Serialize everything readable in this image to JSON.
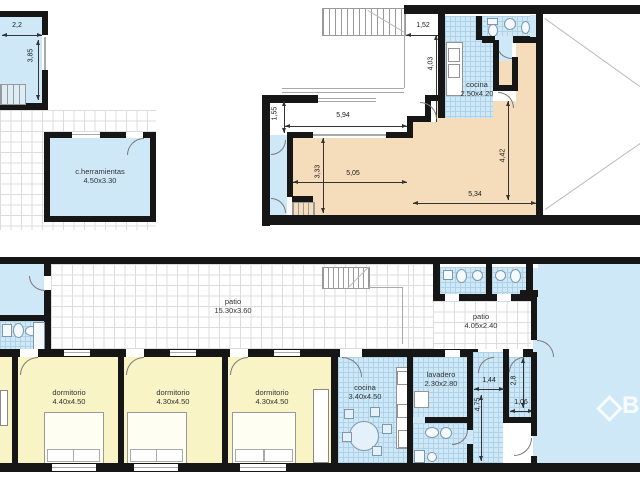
{
  "plan": {
    "upper": {
      "room_tl": {
        "width_dim": "2,2",
        "height_dim": "3,85"
      },
      "herramientas": {
        "name": "c.herramientas",
        "size": "4.50x3.30"
      },
      "cocina": {
        "name": "cocina",
        "size": "2.50x4.20"
      },
      "dims": {
        "stair_gap": "1,52",
        "void_height": "4,03",
        "void_width": "5,94",
        "entry_width": "1,55",
        "hall_height": "3,33",
        "hall_width": "5,05",
        "living_height": "4,42",
        "living_width": "5,34"
      }
    },
    "lower": {
      "patio_main": {
        "name": "patio",
        "size": "15.30x3.60"
      },
      "patio_small": {
        "name": "patio",
        "size": "4.05x2.40"
      },
      "dorm1": {
        "name": "dormitorio",
        "size": "4.40x4.50"
      },
      "dorm2": {
        "name": "dormitorio",
        "size": "4.30x4.50"
      },
      "dorm3": {
        "name": "dormitorio",
        "size": "4.30x4.50"
      },
      "cocina": {
        "name": "cocina",
        "size": "3.40x4.50"
      },
      "lavadero": {
        "name": "lavadero",
        "size": "2.30x2.80"
      },
      "dims": {
        "corridor_width": "1,44",
        "corridor_length": "4,75",
        "small_room_height": "2,8",
        "small_room_width": "1,06"
      }
    },
    "watermark": {
      "letter": "B"
    },
    "colors": {
      "room_blue": "#cfe8f7",
      "tile_line": "#aed3e8",
      "bedroom_yellow": "#f8f4c5",
      "living_salmon": "#f5dcba",
      "wall": "#161616",
      "patio_grid": "#dcdcdc"
    }
  }
}
